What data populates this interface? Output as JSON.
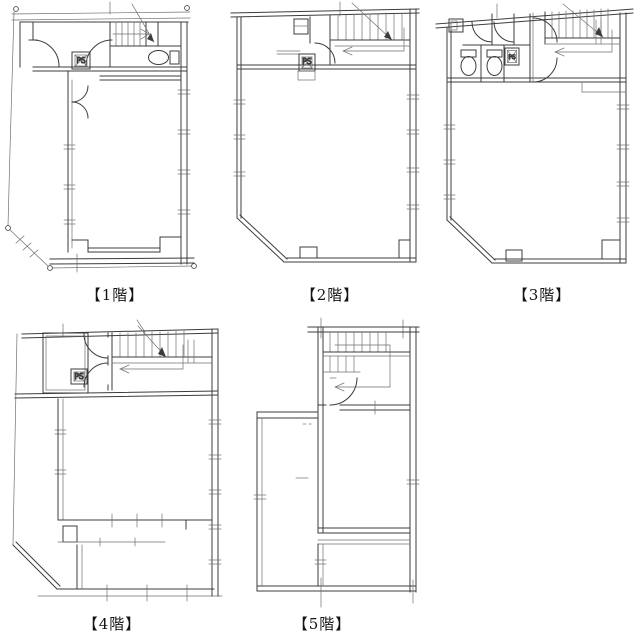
{
  "sheet": {
    "background": "#ffffff",
    "line_color": "#3c3c3c",
    "description": "Five hand-drafted building floor plans"
  },
  "floors": [
    {
      "id": "1F",
      "label": "【1階】",
      "ps_label": "PS",
      "features": [
        "site-boundary-markers",
        "entrance-doors",
        "staircase-with-up-arrow",
        "toilet",
        "pipe-space",
        "open-floor"
      ]
    },
    {
      "id": "2F",
      "label": "【2階】",
      "ps_label": "PS",
      "features": [
        "staircase-with-up-arrow",
        "closet",
        "pipe-space",
        "door",
        "chamfered-corner",
        "open-floor"
      ]
    },
    {
      "id": "3F",
      "label": "【3階】",
      "ps_label": "PS",
      "features": [
        "two-toilet-stalls",
        "staircase-with-up-arrow",
        "pipe-space",
        "doors",
        "chamfered-corner",
        "open-floor"
      ]
    },
    {
      "id": "4F",
      "label": "【4階】",
      "ps_label": "PS",
      "features": [
        "staircase-with-up-arrow",
        "storage-room",
        "pipe-space",
        "doors",
        "chamfered-corner",
        "open-floor"
      ]
    },
    {
      "id": "5F",
      "label": "【5階】",
      "features": [
        "penthouse-staircase",
        "door",
        "roof-terrace",
        "parapet-walls"
      ]
    }
  ]
}
